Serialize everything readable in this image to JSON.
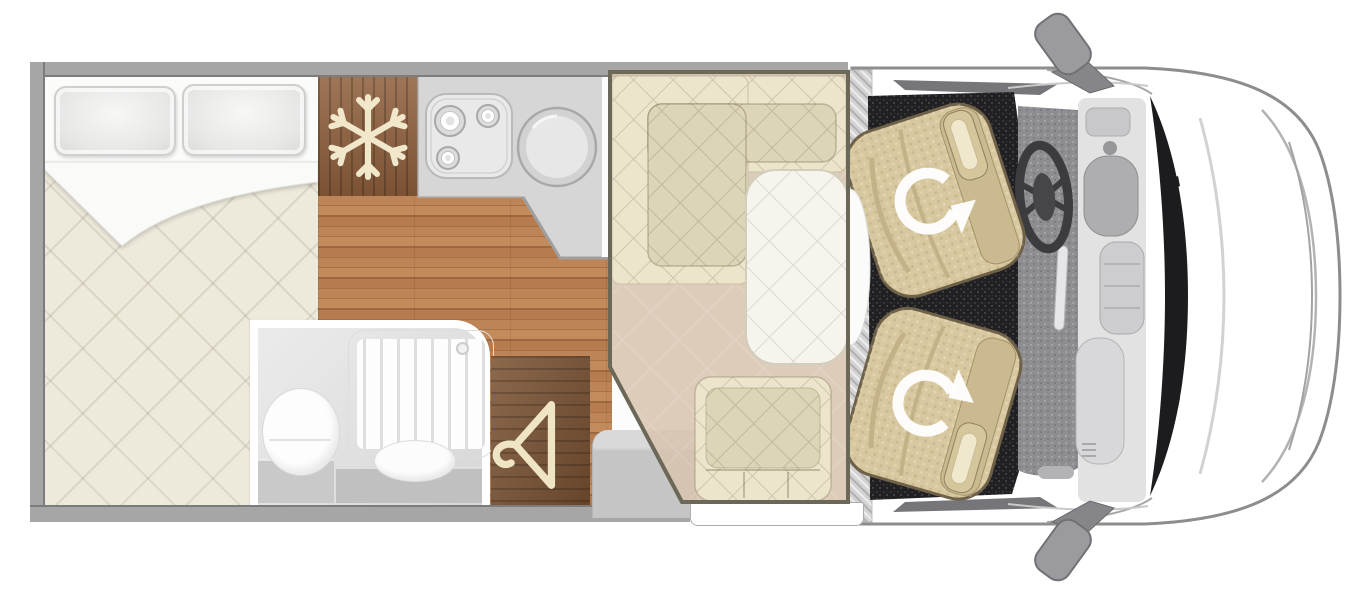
{
  "plan": {
    "view": "top-down floor plan of a van conversion motorhome",
    "colors": {
      "wall": "#a6a6a6",
      "wall_edge": "#7c7c7c",
      "wood": "#b57c4e",
      "wood_fridge": "#8f5f3c",
      "wood_wardrobe": "#7c5434",
      "counter": "#d7d7d7",
      "mattress": "#edeadc",
      "white_sheet": "#fbfbfa",
      "bench": "#ece5cc",
      "bench_inner": "#ddd5b8",
      "table": "#f6f4ec",
      "zone_floor": "#d8c4ae",
      "zone_border": "#6c6857",
      "seat": "#d8c89f",
      "seat_dark": "#cbba8f",
      "carpet": "#202023",
      "mat": "#8e8e92",
      "dash": "#e2e2e3",
      "dark": "#3c3c3f",
      "body_line": "#8d8d8d",
      "cream": "#f1e8cc",
      "step": "#c9c9c9"
    },
    "areas": [
      {
        "name": "rear-bed",
        "pillows": 2
      },
      {
        "name": "fridge-freezer",
        "icon": "snowflake-icon"
      },
      {
        "name": "kitchen",
        "hob_burners": 3,
        "sinks": 1
      },
      {
        "name": "bathroom",
        "fixtures": [
          "toilet",
          "shower",
          "washbasin"
        ]
      },
      {
        "name": "wardrobe",
        "icon": "hanger-icon"
      },
      {
        "name": "dinette-lounge",
        "bench": "L-shaped",
        "tables": 1,
        "single_seats": 1,
        "highlighted": true
      },
      {
        "name": "driver-cab",
        "swivel_seats": 2,
        "icon": "swivel-arrow-icon",
        "mirrors": 2,
        "steering_wheels": 1
      }
    ]
  }
}
